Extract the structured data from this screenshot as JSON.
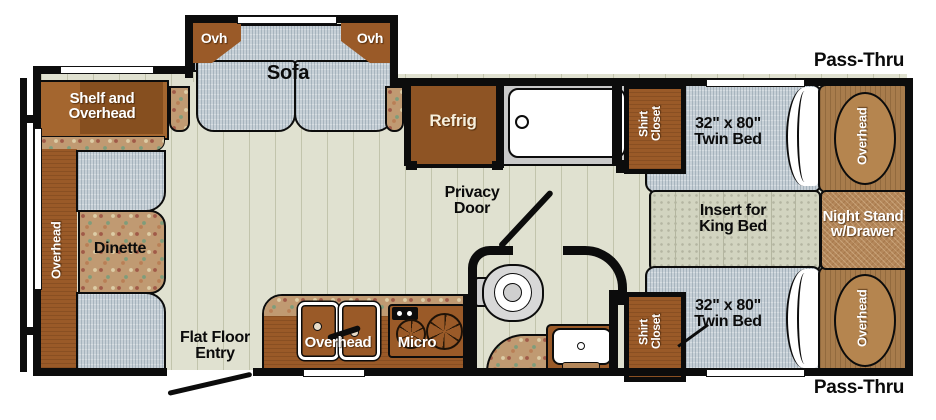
{
  "title": "Travel trailer floor plan",
  "colors": {
    "wall": "#0c0c0c",
    "floor": "#e0e1d0",
    "cabinet_brown": "#9a5a28",
    "refrigerator_brown": "#8e5424",
    "bedroom_panel_brown": "#a87c4c",
    "night_stand_tan": "#b4875a",
    "upholstery_gray": "#c7d0d7",
    "king_insert_gray": "#d2d4c0",
    "countertop_floral_base": "#c09a72",
    "label_white": "#ffffff",
    "label_black": "#0b0b0b"
  },
  "labels": {
    "ovh_left": "Ovh",
    "ovh_right": "Ovh",
    "sofa": "Sofa",
    "shelf_overhead": "Shelf and\nOverhead",
    "dinette_overhead": "Overhead",
    "dinette": "Dinette",
    "refrig": "Refrig",
    "privacy_door": "Privacy\nDoor",
    "flat_floor_entry": "Flat Floor\nEntry",
    "kitchen_overhead": "Overhead",
    "micro": "Micro",
    "shirt_closet_top": "Shirt\nCloset",
    "shirt_closet_bottom": "Shirt\nCloset",
    "twin_bed_top": "32\" x 80\"\nTwin Bed",
    "twin_bed_bottom": "32\" x 80\"\nTwin Bed",
    "insert_king": "Insert for\nKing Bed",
    "night_stand": "Night Stand\nw/Drawer",
    "overhead_bed_top": "Overhead",
    "overhead_bed_bottom": "Overhead",
    "pass_thru_top": "Pass-Thru",
    "pass_thru_bottom": "Pass-Thru"
  }
}
